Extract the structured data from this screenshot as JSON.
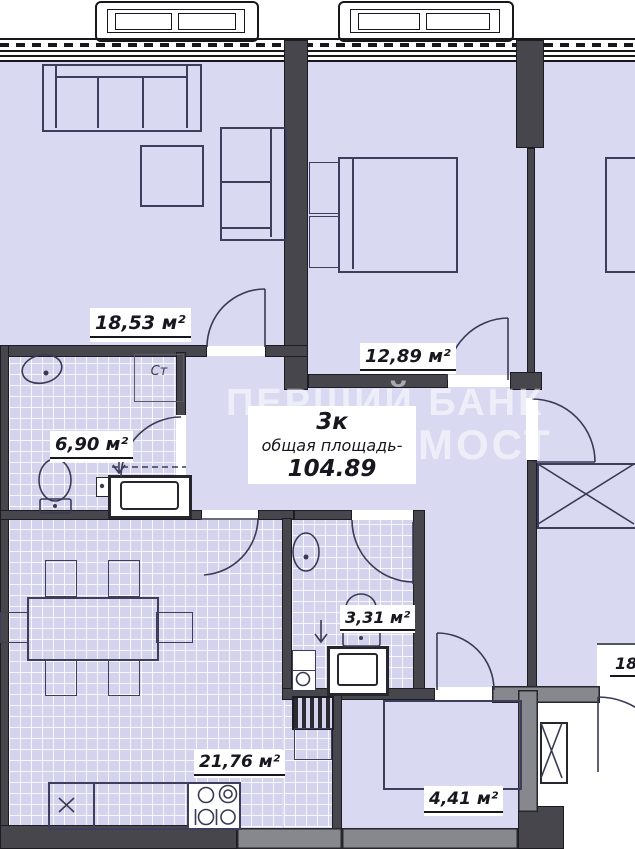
{
  "plan": {
    "unit": {
      "type": "3к",
      "caption": "общая площадь-",
      "value": "104.89"
    },
    "labels": {
      "living": "18,53 м²",
      "bedroom": "12,89 м²",
      "bathroom": "6,90 м²",
      "wc": "3,31 м²",
      "kitchen": "21,76 м²",
      "balcony": "4,41 м²",
      "neighbor_fragment": "18,",
      "washer_spot": "Ст"
    },
    "watermark": {
      "line1": "ПЕРШИЙ БАНК",
      "line2": "МОСТ"
    },
    "colors": {
      "floor": "#d9d9f2",
      "tile_floor": "#d3d3ee",
      "wall_dark": "#46464c",
      "wall_gray": "#87878e",
      "furniture_line": "#3d3d5c",
      "label_text": "#17171f",
      "outside": "#ffffff",
      "watermark": "rgba(255,255,255,0.55)"
    }
  }
}
